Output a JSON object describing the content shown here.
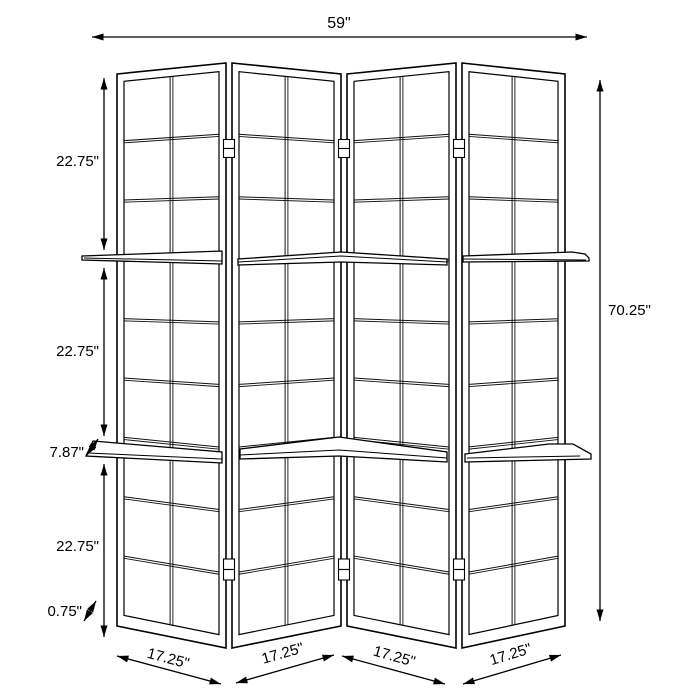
{
  "figure": {
    "name": "four-panel-folding-screen-with-two-shelves",
    "panel_count": 4,
    "shelf_count": 2
  },
  "dimensions": {
    "overall_width": "59\"",
    "overall_height": "70.25\"",
    "section_heights": [
      "22.75\"",
      "22.75\"",
      "22.75\""
    ],
    "shelf_depth": "7.87\"",
    "frame_thickness": "0.75\"",
    "panel_widths": [
      "17.25\"",
      "17.25\"",
      "17.25\"",
      "17.25\""
    ]
  },
  "colors": {
    "line": "#000000",
    "background": "#ffffff"
  }
}
